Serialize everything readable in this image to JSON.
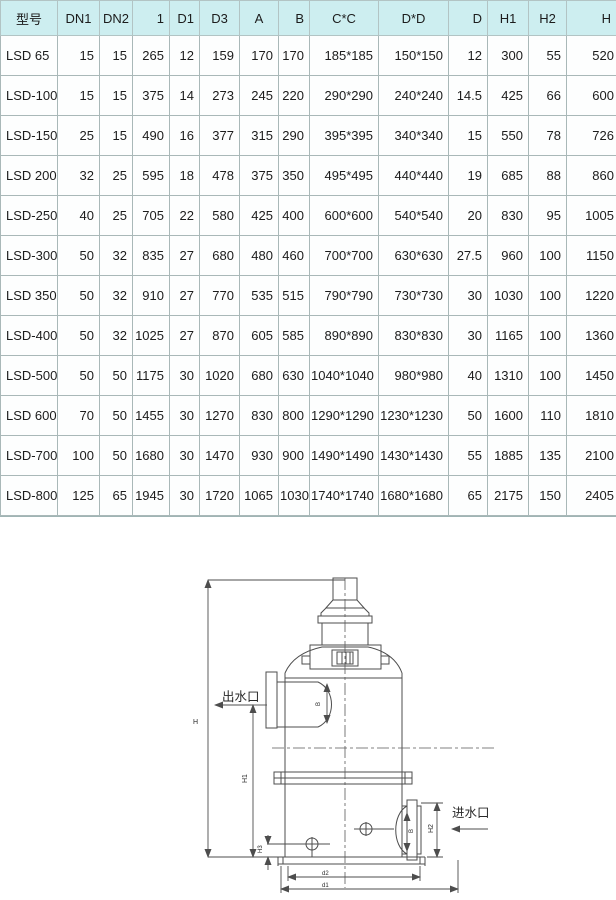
{
  "table": {
    "headers": [
      "型号",
      "DN1",
      "DN2",
      "1",
      "D1",
      "D3",
      "A",
      "B",
      "C*C",
      "D*D",
      "D",
      "H1",
      "H2",
      "H"
    ],
    "rows": [
      [
        "LSD 65",
        "15",
        "15",
        "265",
        "12",
        "159",
        "170",
        "170",
        "185*185",
        "150*150",
        "12",
        "300",
        "55",
        "520"
      ],
      [
        "LSD-100",
        "15",
        "15",
        "375",
        "14",
        "273",
        "245",
        "220",
        "290*290",
        "240*240",
        "14.5",
        "425",
        "66",
        "600"
      ],
      [
        "LSD-150",
        "25",
        "15",
        "490",
        "16",
        "377",
        "315",
        "290",
        "395*395",
        "340*340",
        "15",
        "550",
        "78",
        "726"
      ],
      [
        "LSD 200",
        "32",
        "25",
        "595",
        "18",
        "478",
        "375",
        "350",
        "495*495",
        "440*440",
        "19",
        "685",
        "88",
        "860"
      ],
      [
        "LSD-250",
        "40",
        "25",
        "705",
        "22",
        "580",
        "425",
        "400",
        "600*600",
        "540*540",
        "20",
        "830",
        "95",
        "1005"
      ],
      [
        "LSD-300",
        "50",
        "32",
        "835",
        "27",
        "680",
        "480",
        "460",
        "700*700",
        "630*630",
        "27.5",
        "960",
        "100",
        "1150"
      ],
      [
        "LSD 350",
        "50",
        "32",
        "910",
        "27",
        "770",
        "535",
        "515",
        "790*790",
        "730*730",
        "30",
        "1030",
        "100",
        "1220"
      ],
      [
        "LSD-400",
        "50",
        "32",
        "1025",
        "27",
        "870",
        "605",
        "585",
        "890*890",
        "830*830",
        "30",
        "1165",
        "100",
        "1360"
      ],
      [
        "LSD-500",
        "50",
        "50",
        "1175",
        "30",
        "1020",
        "680",
        "630",
        "1040*1040",
        "980*980",
        "40",
        "1310",
        "100",
        "1450"
      ],
      [
        "LSD 600",
        "70",
        "50",
        "1455",
        "30",
        "1270",
        "830",
        "800",
        "1290*1290",
        "1230*1230",
        "50",
        "1600",
        "110",
        "1810"
      ],
      [
        "LSD-700",
        "100",
        "50",
        "1680",
        "30",
        "1470",
        "930",
        "900",
        "1490*1490",
        "1430*1430",
        "55",
        "1885",
        "135",
        "2100"
      ],
      [
        "LSD-800",
        "125",
        "65",
        "1945",
        "30",
        "1720",
        "1065",
        "1030",
        "1740*1740",
        "1680*1680",
        "65",
        "2175",
        "150",
        "2405"
      ]
    ]
  },
  "diagram": {
    "outlet_label": "出水口",
    "inlet_label": "进水口",
    "dim_labels": {
      "height_total": "H",
      "height_body": "H1",
      "height_left": "H3",
      "height_right": "H2",
      "outlet_port": "B",
      "inlet_port": "B",
      "base_inner": "d2",
      "base_outer": "d1"
    }
  },
  "colors": {
    "page_bg": "#cdeef0",
    "cell_bg": "#fdfefe",
    "grid": "#a9b8b8",
    "text": "#1c1c1c",
    "line": "#4d4d4d",
    "lower_bg": "#ffffff"
  }
}
